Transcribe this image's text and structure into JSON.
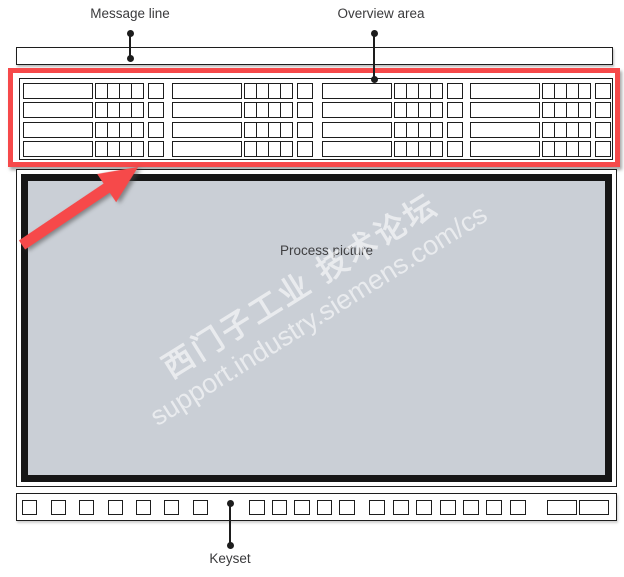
{
  "labels": {
    "message_line": "Message line",
    "overview_area": "Overview area",
    "process_picture": "Process picture",
    "keyset": "Keyset"
  },
  "watermark": {
    "line1": "西门子工业 技术论坛",
    "line2": "support.industry.siemens.com/cs"
  },
  "overview_area": {
    "group_count": 4,
    "rows_per_group": 4,
    "cells_per_row": 4,
    "extra_cells_per_row": 1
  },
  "keyset": {
    "sections": [
      {
        "name": "spaced-key",
        "count": 7
      },
      {
        "name": "group-a-key",
        "count": 5
      },
      {
        "name": "group-b-key",
        "count": 7
      },
      {
        "name": "wide-key",
        "count": 2
      }
    ]
  },
  "colors": {
    "highlight_red": "#f6494a",
    "arrow_red": "#f6494a",
    "process_fill": "#cacfd6",
    "border_ink": "#1d1d1d",
    "label_text": "#3a3a3c"
  }
}
